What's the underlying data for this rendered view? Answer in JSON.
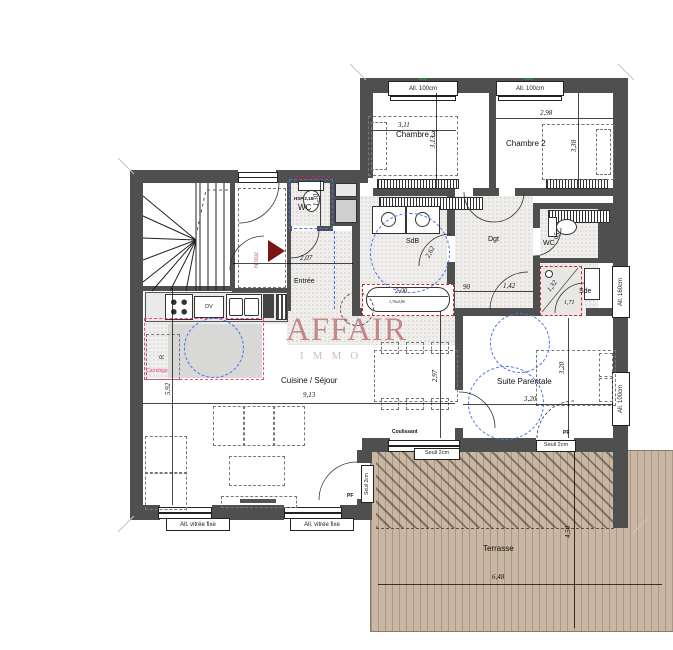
{
  "watermark": {
    "title": "AFFAIR",
    "subtitle": "IMMO"
  },
  "unit": {
    "numero": "N 002"
  },
  "rooms": {
    "chambre3": {
      "label": "Chambre 3",
      "width": "3,11",
      "height": "3,13"
    },
    "chambre2": {
      "label": "Chambre 2",
      "width": "2,98",
      "height": "3,38"
    },
    "wc1": {
      "label": "WC",
      "note": "HSP 2,18",
      "depth": "1,30"
    },
    "entree": {
      "label": "Entrée",
      "width": "2,07"
    },
    "sdb": {
      "label": "SdB",
      "diameter": "2,62",
      "tub_length": "2,00",
      "tub_size": "1,70x0,80"
    },
    "dgt": {
      "label": "Dgt",
      "dim1": "90",
      "dim2": "1,42"
    },
    "wc2": {
      "label": "WC",
      "width": "95"
    },
    "sde": {
      "label": "Sde",
      "dim1": "1,32",
      "dim2": "1,71"
    },
    "sejour": {
      "label": "Cuisine / Séjour",
      "width": "9,13",
      "height": "5,92",
      "table_depth": "2,97"
    },
    "suite": {
      "label": "Suite Parentale",
      "width": "3,20",
      "height": "3,20"
    },
    "terrasse": {
      "label": "Terrasse",
      "width": "6,48",
      "height": "4,50"
    }
  },
  "openings": {
    "allege_100": "All. 100cm",
    "allege_160": "All. 160cm",
    "vitree_fixe": "All. vitrée fixe",
    "coulissant": "Coulissant",
    "seuil": "Seuil 2cm",
    "porte_fenetre": "PF"
  },
  "kitchen": {
    "lave_vaisselle": "DV",
    "refrigerateur": "R"
  },
  "notes": {
    "carrelage": "Carrelage"
  },
  "colors": {
    "wall": "#4f4f4f",
    "terrace": "#c9b7a4",
    "accent_red": "#cc2a2a",
    "accent_pink": "#f0428c",
    "accent_blue": "#4673e8",
    "watermark": "#a83e42"
  }
}
